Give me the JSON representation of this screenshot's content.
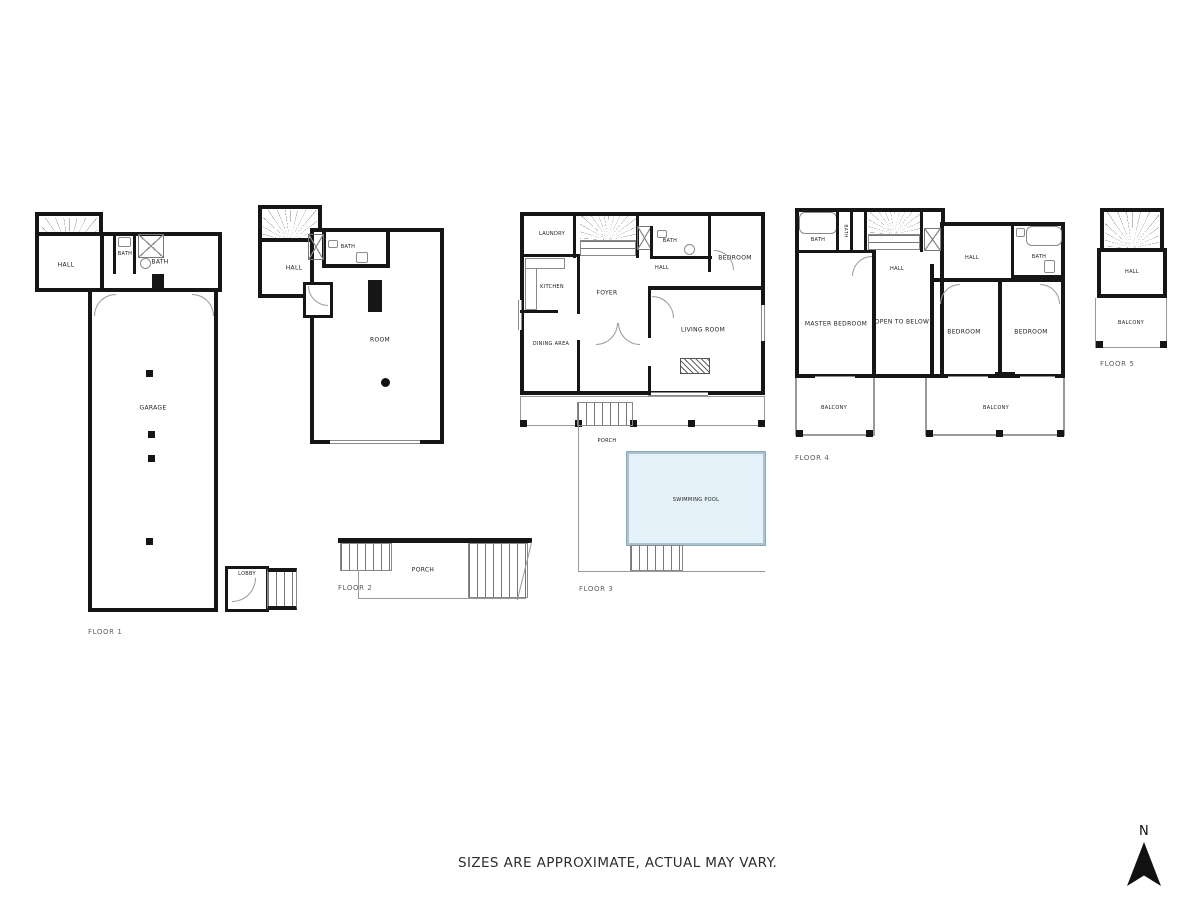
{
  "disclaimer": "SIZES ARE APPROXIMATE, ACTUAL MAY VARY.",
  "compass_label": "N",
  "floor1": {
    "name": "FLOOR 1",
    "hall": "HALL",
    "bath_small": "BATH",
    "bath": "BATH",
    "garage": "GARAGE",
    "lobby": "LOBBY"
  },
  "floor2": {
    "name": "FLOOR 2",
    "hall": "HALL",
    "bath": "BATH",
    "room": "ROOM",
    "porch": "PORCH"
  },
  "floor3": {
    "name": "FLOOR 3",
    "laundry": "LAUNDRY",
    "kitchen": "KITCHEN",
    "dining_area": "DINING AREA",
    "foyer": "FOYER",
    "hall": "HALL",
    "bath": "BATH",
    "bedroom": "BEDROOM",
    "living_room": "LIVING ROOM",
    "porch": "PORCH",
    "swimming_pool": "SWIMMING POOL"
  },
  "floor4": {
    "name": "FLOOR 4",
    "bath_left": "BATH",
    "bath_closet": "BATH",
    "hall_left": "HALL",
    "hall_right": "HALL",
    "bath_right": "BATH",
    "master_bedroom": "MASTER BEDROOM",
    "open_to_below": "OPEN TO BELOW",
    "bedroom_mid": "BEDROOM",
    "bedroom_right": "BEDROOM",
    "balcony_left": "BALCONY",
    "balcony_right": "BALCONY"
  },
  "floor5": {
    "name": "FLOOR 5",
    "hall": "HALL",
    "balcony": "BALCONY"
  },
  "colors": {
    "wall": "#161616",
    "pool_fill": "#e4f1f9",
    "line": "#9a9a9a"
  }
}
